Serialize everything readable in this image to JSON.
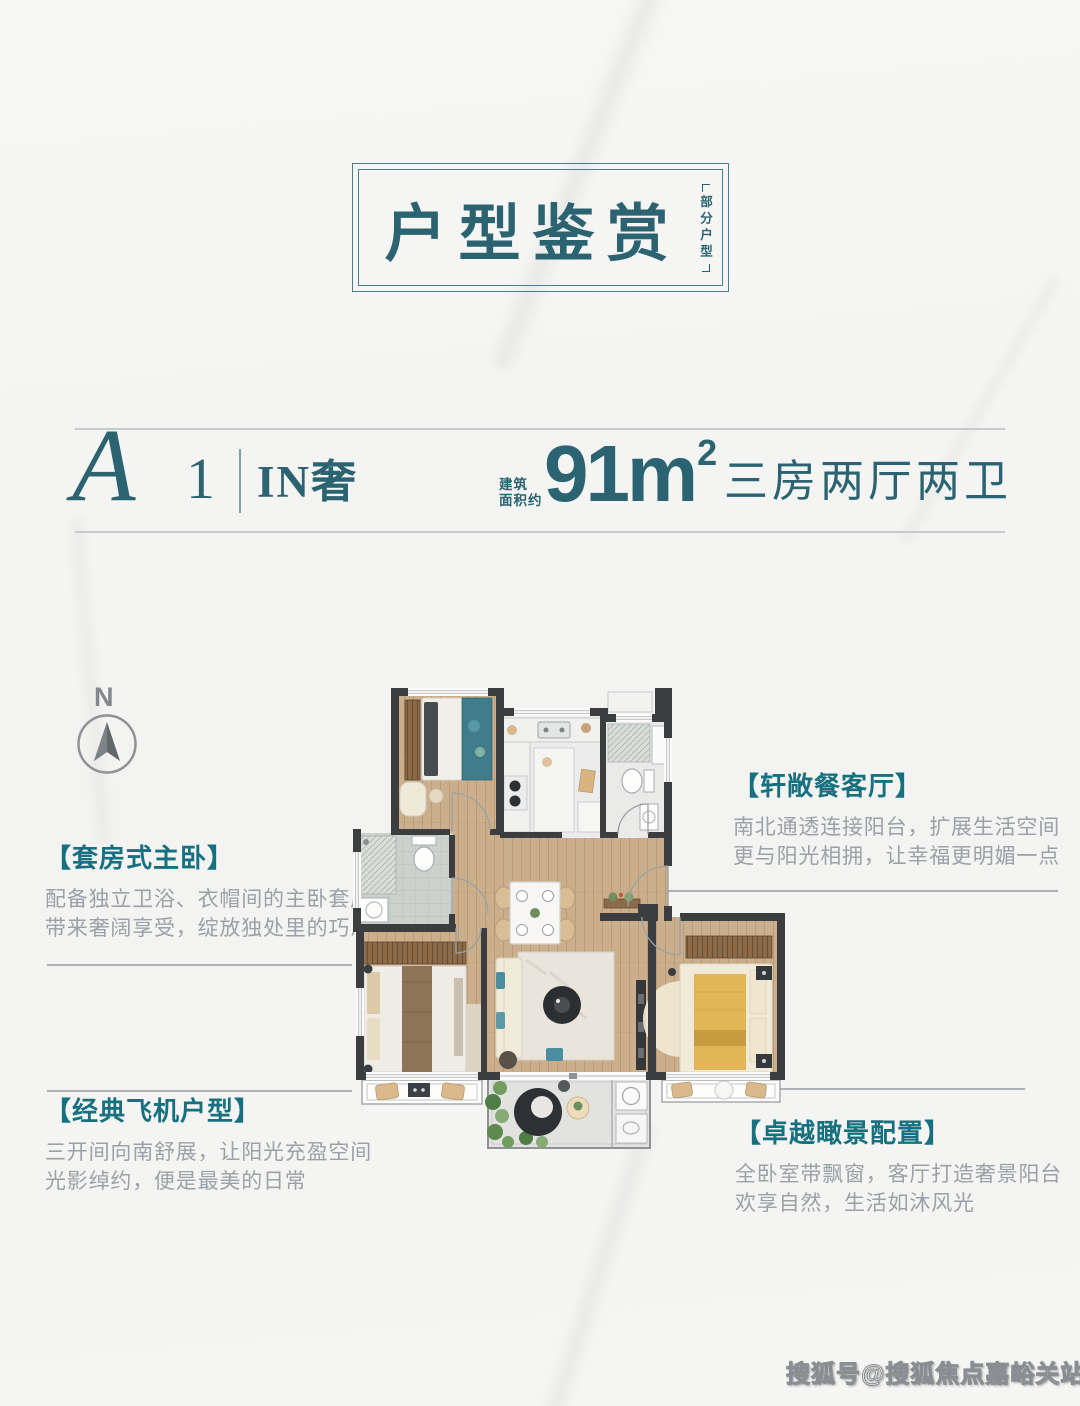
{
  "title_box": {
    "title": "户型鉴赏",
    "side_note": "部分户型"
  },
  "unit_header": {
    "code_letter": "A",
    "code_number": "1",
    "name": "IN奢",
    "area_label_line1": "建筑",
    "area_label_line2": "面积约",
    "area_value": "91m",
    "area_superscript": "2",
    "rooms_summary": "三房两厅两卫"
  },
  "compass": {
    "north_label": "N"
  },
  "callouts": [
    {
      "id": "dining",
      "title": "【轩敞餐客厅】",
      "lines": [
        "南北通透连接阳台，扩展生活空间",
        "更与阳光相拥，让幸福更明媚一点"
      ]
    },
    {
      "id": "master",
      "title": "【套房式主卧】",
      "lines": [
        "配备独立卫浴、衣帽间的主卧套房",
        "带来奢阔享受，绽放独处里的巧思"
      ]
    },
    {
      "id": "classic",
      "title": "【经典飞机户型】",
      "lines": [
        "三开间向南舒展，让阳光充盈空间",
        "光影绰约，便是最美的日常"
      ]
    },
    {
      "id": "view",
      "title": "【卓越瞰景配置】",
      "lines": [
        "全卧室带飘窗，客厅打造奢景阳台",
        "欢享自然，生活如沐风光"
      ]
    }
  ],
  "watermark": "搜狐号@搜狐焦点嘉峪关站",
  "colors": {
    "teal_dark": "#2b6370",
    "teal_bright": "#17707f",
    "frame_teal": "#4a7e8b",
    "body_gray": "#9ba1a6",
    "lead_line_gray": "#abb1b4",
    "wall": "#3b3d3f",
    "wood_floor": "#cbaf8d",
    "accent_teal": "#4b8ea0",
    "accent_yellow": "#e2b556",
    "background": "#f5f5f3"
  }
}
